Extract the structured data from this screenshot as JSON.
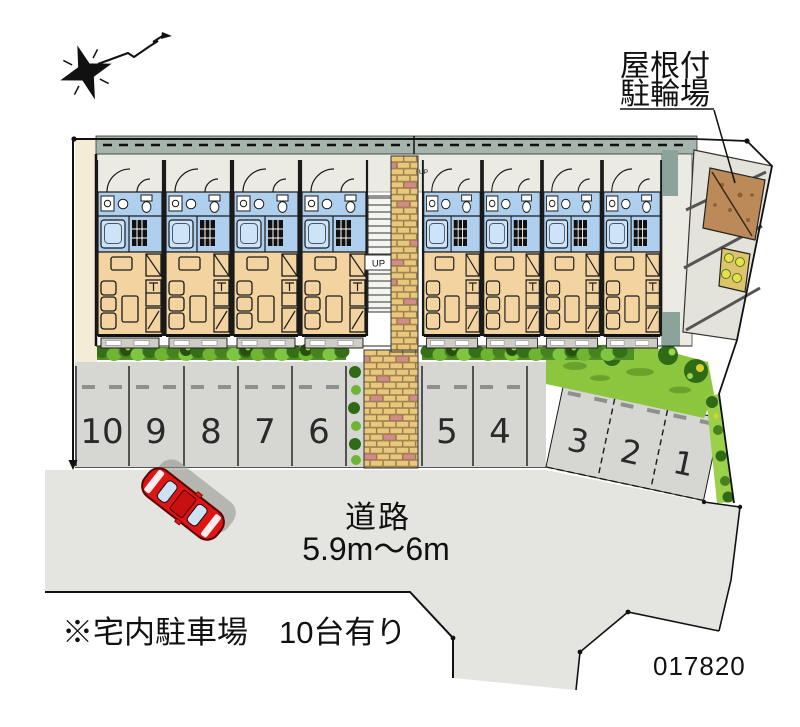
{
  "labels": {
    "bike_parking_line1": "屋根付",
    "bike_parking_line2": "駐輪場",
    "road_name": "道路",
    "road_width": "5.9m～6m",
    "parking_note": "※宅内駐車場　10台有り",
    "plan_number": "017820",
    "stairs_up": "UP"
  },
  "parking": {
    "spaces_straight": [
      "10",
      "9",
      "8",
      "7",
      "6",
      "5",
      "4"
    ],
    "spaces_angled": [
      "3",
      "2",
      "1"
    ]
  },
  "building": {
    "unit_count": 8
  },
  "colors": {
    "road": "#e4e4e1",
    "parking": "#d6d6d3",
    "room_tan": "#f3d4a0",
    "water_blue": "#aed0ee",
    "brick": "#e9c87d",
    "brick_accent": "#d18b8b",
    "hedge": "#4f8f26",
    "lawn": "#8cc63f",
    "car_red": "#dd1515",
    "roof_band": "#a6b4ae",
    "corridor": "#ecebe3",
    "line": "#1a1a1a"
  }
}
